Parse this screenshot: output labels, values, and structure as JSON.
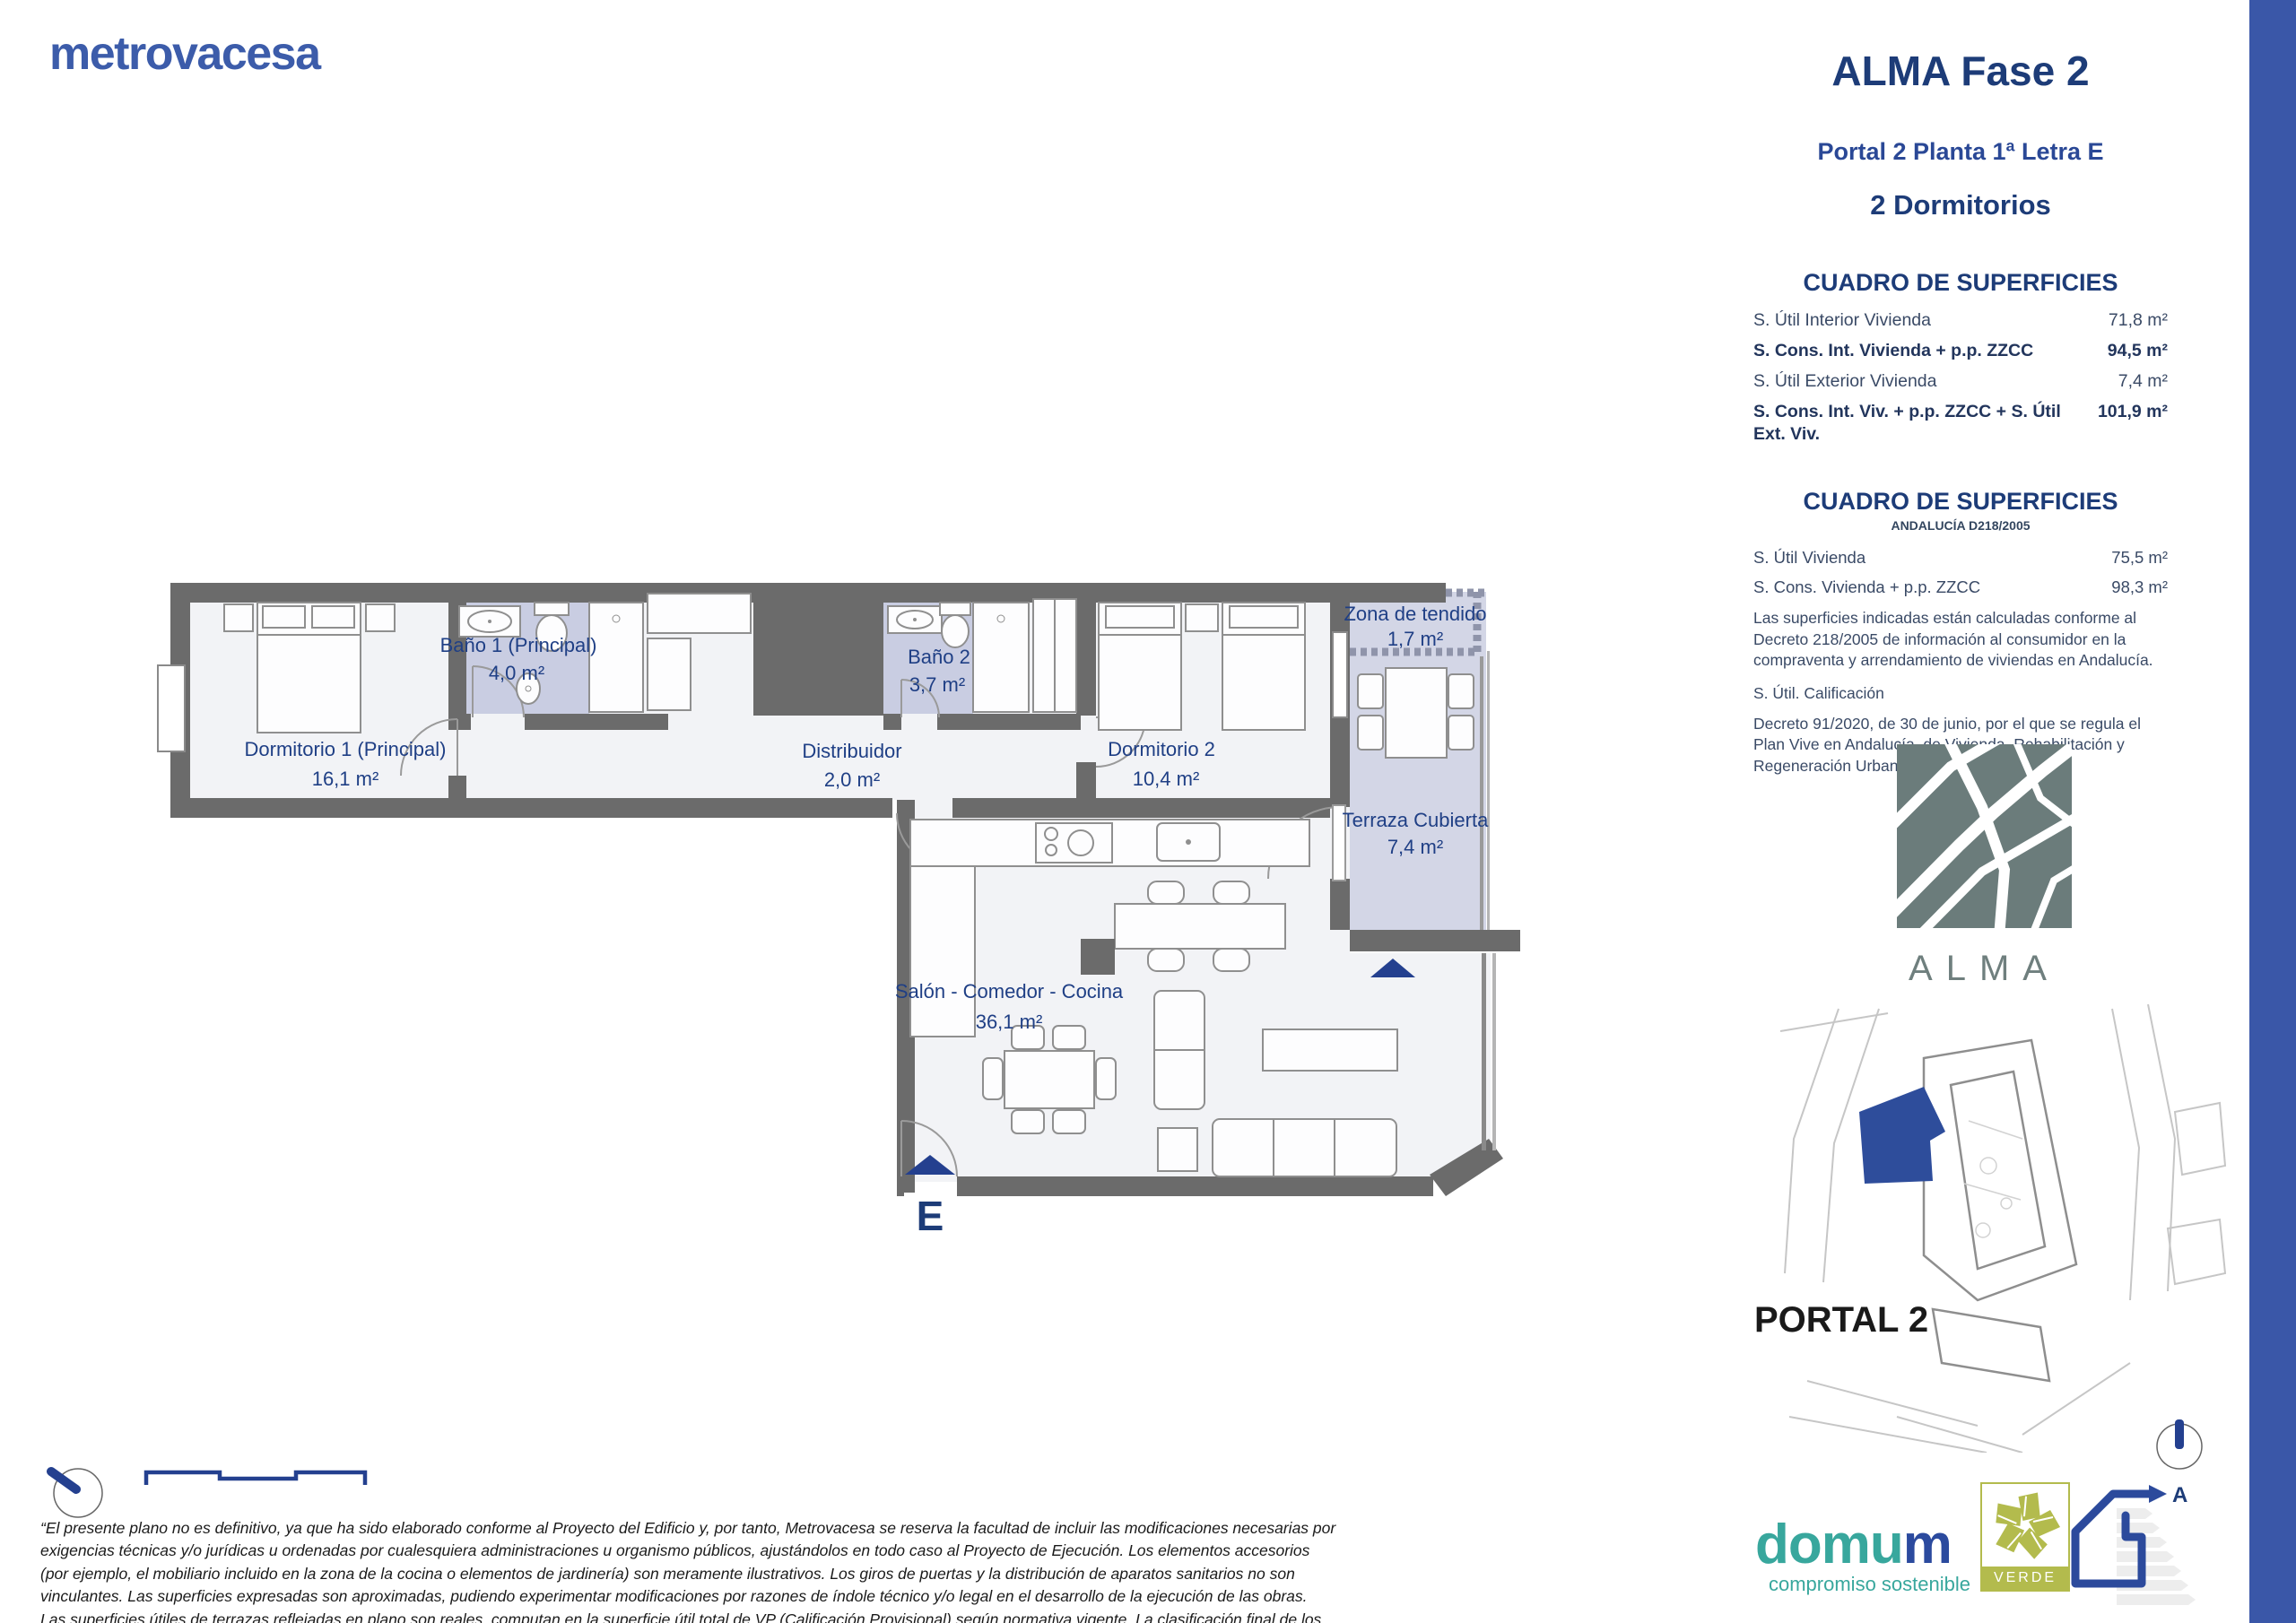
{
  "colors": {
    "brand_blue": "#3c5caa",
    "navy": "#1d3c78",
    "side_bar_blue": "#3a57a8",
    "bath_lavender": "#c9cde2",
    "terrace_lavender": "#d3d6e6",
    "wall_gray": "#6b6b6b",
    "alma_slate": "#6f7f7e",
    "verde_olive": "#b3bb4d",
    "domum_teal": "#38a79d"
  },
  "brand": {
    "logo_text": "metrovacesa"
  },
  "header": {
    "project_title": "ALMA Fase 2",
    "unit_line": "Portal 2 Planta 1ª Letra E",
    "type_line": "2 Dormitorios"
  },
  "surface_table": {
    "title": "CUADRO DE SUPERFICIES",
    "rows": [
      {
        "label": "S. Útil Interior Vivienda",
        "value": "71,8 m²"
      },
      {
        "label": "S. Cons. Int. Vivienda + p.p. ZZCC",
        "value": "94,5 m²"
      },
      {
        "label": "S. Útil Exterior Vivienda",
        "value": "7,4 m²"
      },
      {
        "label": "S. Cons. Int. Viv. + p.p. ZZCC + S. Útil Ext. Viv.",
        "value": "101,9 m²"
      }
    ]
  },
  "surface_table_andalucia": {
    "title": "CUADRO DE SUPERFICIES",
    "subtitle": "ANDALUCÍA D218/2005",
    "rows": [
      {
        "label": "S. Útil Vivienda",
        "value": "75,5 m²"
      },
      {
        "label": "S. Cons. Vivienda + p.p. ZZCC",
        "value": "98,3 m²"
      }
    ],
    "note_decreto218": "Las superficies indicadas están calculadas conforme al Decreto 218/2005 de información al consumidor en la compraventa y arrendamiento de viviendas en Andalucía.",
    "calificacion_label": "S. Útil. Calificación",
    "note_decreto91": "Decreto 91/2020, de 30 de junio, por el que se regula el Plan Vive en Andalucía, de Vivienda, Rehabilitación y Regeneración Urbana 2020-2030."
  },
  "floorplan": {
    "rooms": {
      "dormitorio1": {
        "name": "Dormitorio 1 (Principal)",
        "area": "16,1 m²"
      },
      "bano1": {
        "name": "Baño 1 (Principal)",
        "area": "4,0 m²"
      },
      "distribuidor": {
        "name": "Distribuidor",
        "area": "2,0 m²"
      },
      "bano2": {
        "name": "Baño 2",
        "area": "3,7 m²"
      },
      "dormitorio2": {
        "name": "Dormitorio 2",
        "area": "10,4 m²"
      },
      "zona_tendido": {
        "name": "Zona de tendido",
        "area": "1,7 m²"
      },
      "terraza": {
        "name": "Terraza Cubierta",
        "area": "7,4 m²"
      },
      "salon": {
        "name": "Salón - Comedor - Cocina",
        "area": "36,1 m²"
      }
    },
    "entrance_letter": "E"
  },
  "branding_alma": {
    "wordmark": "ALMA"
  },
  "site": {
    "portal_label": "PORTAL 2"
  },
  "footer": {
    "disclaimer": "“El presente plano no es definitivo, ya que ha sido elaborado conforme al Proyecto del Edificio y, por tanto, Metrovacesa se reserva la facultad de incluir las modificaciones necesarias por exigencias técnicas y/o jurídicas u ordenadas por cualesquiera administraciones u organismo públicos, ajustándolos en todo caso al Proyecto de Ejecución. Los elementos accesorios (por ejemplo, el mobiliario incluido en la zona de la cocina o elementos de jardinería) son meramente ilustrativos. Los giros de puertas y la distribución de aparatos sanitarios no son vinculantes. Las superficies expresadas son aproximadas, pudiendo experimentar modificaciones por razones de índole técnico y/o legal en el desarrollo de la ejecución de las obras. Las superficies útiles de terrazas reflejadas en plano son reales, computan en la superficie útil total de VP (Calificación Provisional) según normativa vigente. La clasificación final de los sellos de sostenibilidad se obtendrán tras el desarrollo del Proyecto de Ejecución.”",
    "domum": {
      "name_teal": "domu",
      "name_blue": "m",
      "tagline": "compromiso sostenible"
    },
    "verde_label": "VERDE",
    "energy_rating": "A"
  }
}
